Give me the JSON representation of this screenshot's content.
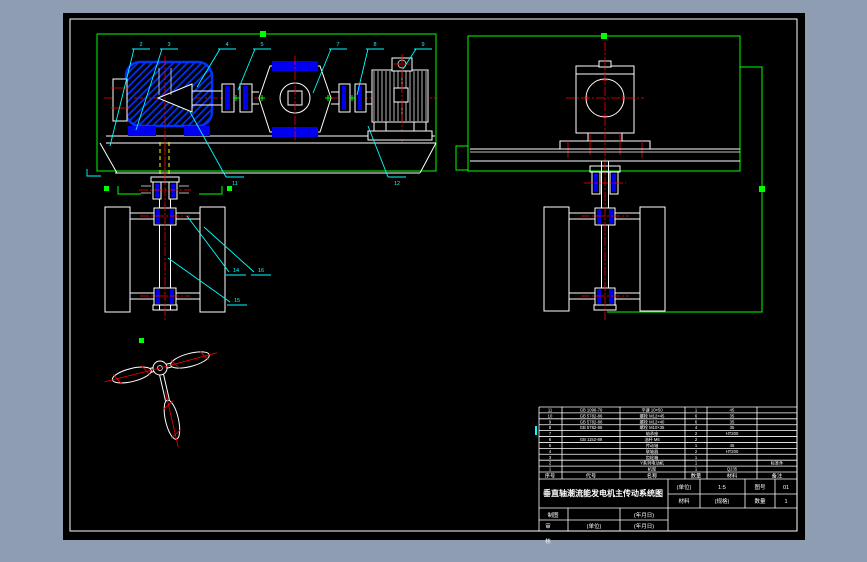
{
  "window": {
    "app_background": "#8f9db2",
    "canvas_background": "#000000",
    "frame_color": "#ffffff"
  },
  "palette": {
    "outline_white": "#ffffff",
    "view_frame_green": "#00ff00",
    "leader_cyan": "#00ffff",
    "centerline_red": "#ff0000",
    "component_blue": "#0000ee",
    "hidden_line_yellow": "#ffff00"
  },
  "views": {
    "side_assembly": {
      "leaders_top": [
        {
          "label": "2"
        },
        {
          "label": "3"
        },
        {
          "label": "4"
        },
        {
          "label": "5"
        },
        {
          "label": "7"
        },
        {
          "label": "8"
        },
        {
          "label": "9"
        }
      ],
      "leaders_bottom": [
        {
          "label": "11"
        },
        {
          "label": "12"
        }
      ]
    },
    "float_front": {
      "leaders": [
        {
          "label": "14"
        },
        {
          "label": "16"
        },
        {
          "label": "15"
        }
      ]
    }
  },
  "title_block": {
    "bom": {
      "headers": [
        "序号",
        "代号",
        "名称",
        "数量",
        "材料",
        "备注"
      ],
      "rows": [
        [
          "11",
          "GB 1096-79",
          "平键 10×50",
          "1",
          "45",
          ""
        ],
        [
          "10",
          "GB 5782-86",
          "螺栓 M12×45",
          "6",
          "35",
          ""
        ],
        [
          "9",
          "GB 5782-86",
          "螺栓 M12×40",
          "6",
          "35",
          ""
        ],
        [
          "8",
          "GB 5782-86",
          "螺栓 M10×35",
          "4",
          "35",
          ""
        ],
        [
          "7",
          "",
          "轴承座",
          "2",
          "HT200",
          ""
        ],
        [
          "6",
          "GB 1152-89",
          "油杯 M6",
          "2",
          "",
          ""
        ],
        [
          "5",
          "",
          "传动轴",
          "1",
          "45",
          ""
        ],
        [
          "4",
          "",
          "联轴器",
          "2",
          "HT200",
          ""
        ],
        [
          "3",
          "",
          "齿轮箱",
          "1",
          "",
          ""
        ],
        [
          "2",
          "",
          "Y系列电动机",
          "1",
          "",
          "标准件"
        ],
        [
          "1",
          "",
          "机架",
          "1",
          "Q235",
          ""
        ]
      ]
    },
    "title": "垂直轴潮流能发电机主传动系统图",
    "info": {
      "unit_label": "(单位)",
      "scale_value": "1:5",
      "drawing_no_label": "图号",
      "drawing_no_value": "01",
      "material_label": "材料",
      "spec_value": "(规格)",
      "qty_label": "数量",
      "qty_value": "1"
    },
    "signature": {
      "draw_label": "制图",
      "draw_date": "(年月日)",
      "check_label": "审",
      "check_org": "(单位)",
      "check_date": "(年月日)",
      "below_border": "核"
    }
  }
}
